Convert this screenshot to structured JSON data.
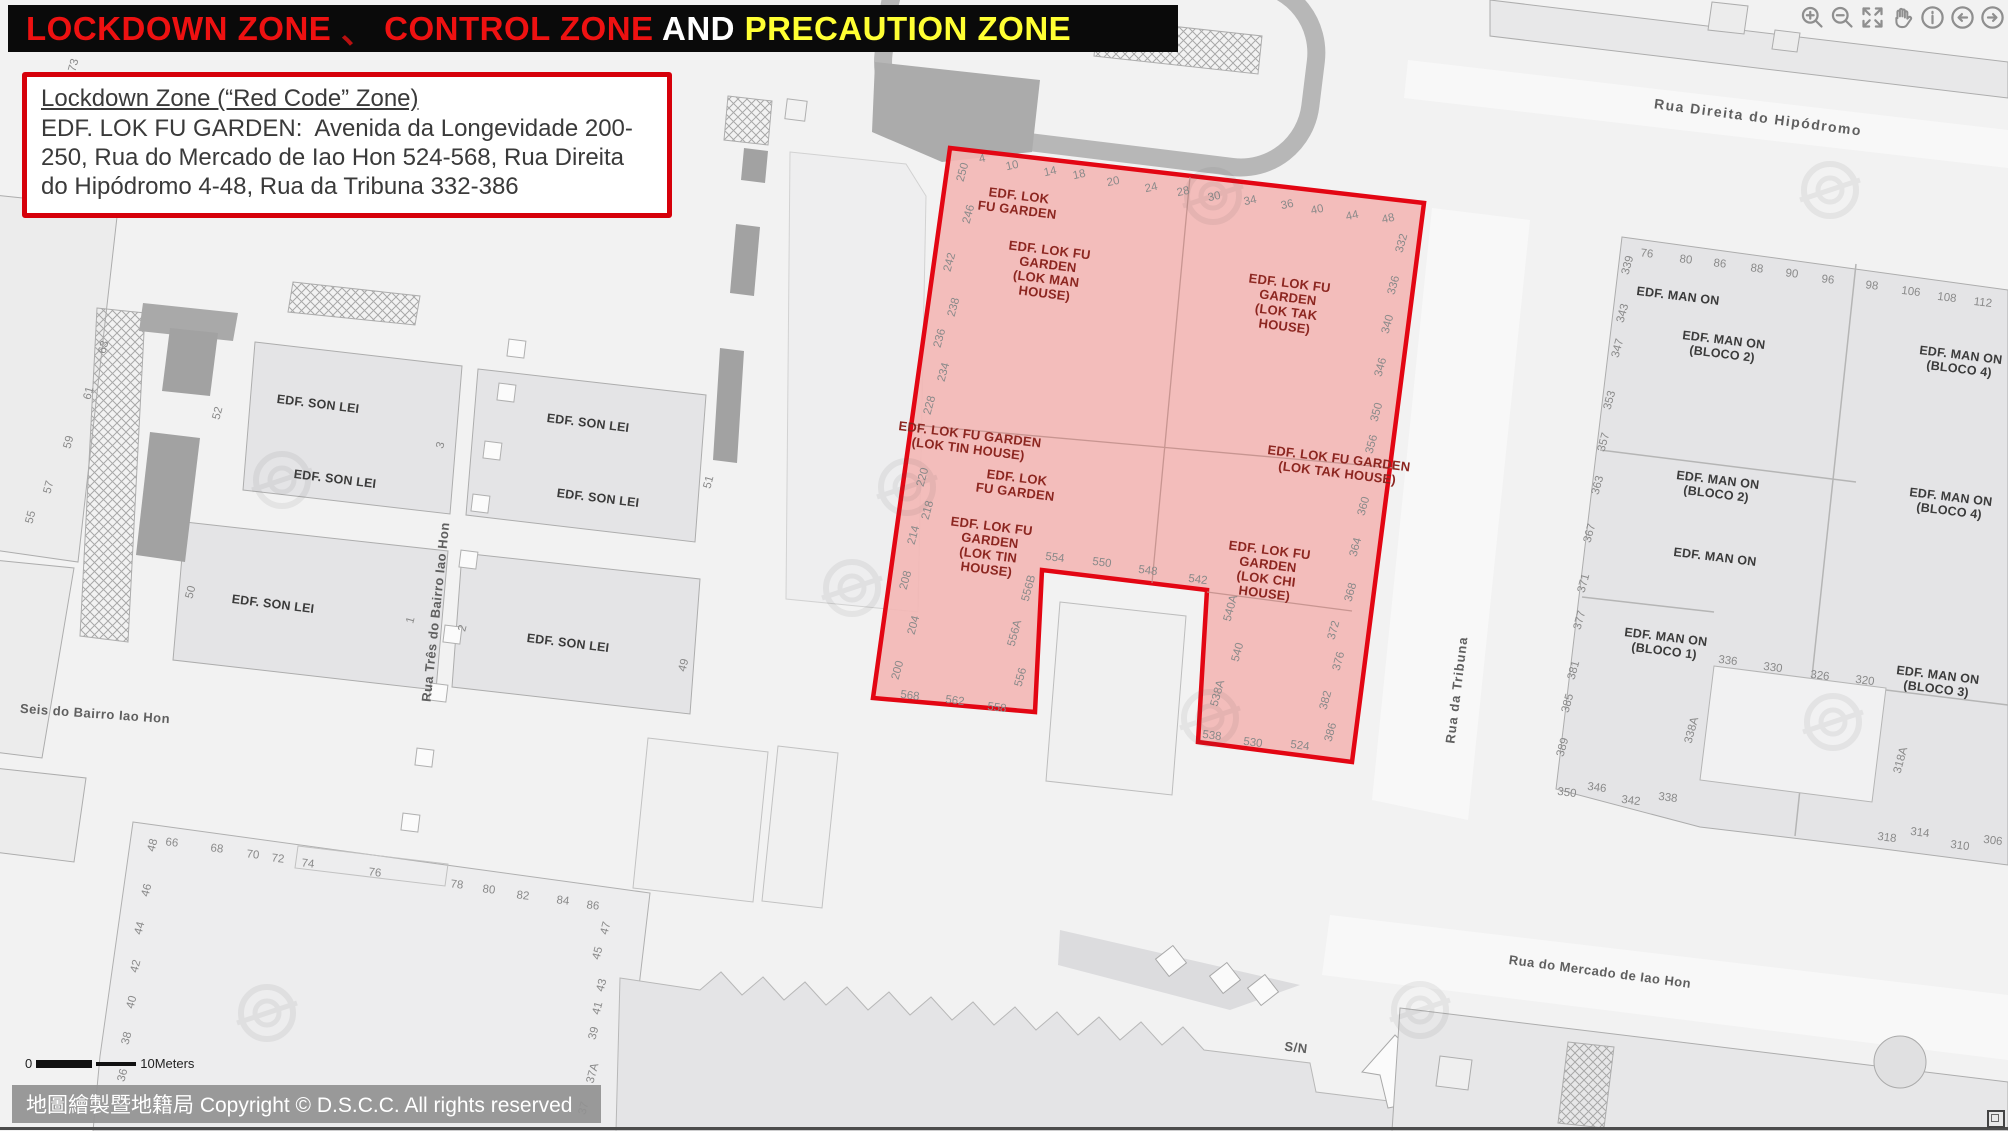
{
  "title": {
    "segments": [
      {
        "text": "LOCKDOWN ZONE",
        "color": "#ee1111"
      },
      {
        "text": " 、 ",
        "color": "#b81010"
      },
      {
        "text": "CONTROL ZONE",
        "color": "#ee1111"
      },
      {
        "text": " AND ",
        "color": "#ffffff"
      },
      {
        "text": "PRECAUTION ZONE",
        "color": "#ffff33"
      }
    ]
  },
  "info_box": {
    "heading": "Lockdown Zone (“Red Code” Zone)",
    "body": "EDF. LOK FU GARDEN:  Avenida da Longevidade 200-250, Rua do Mercado de Iao Hon 524-568, Rua Direita do Hipódromo 4-48, Rua da Tribuna 332-386"
  },
  "toolbar": {
    "icons": [
      {
        "name": "zoom-in"
      },
      {
        "name": "zoom-out"
      },
      {
        "name": "full-extent"
      },
      {
        "name": "pan"
      },
      {
        "name": "info"
      },
      {
        "name": "back"
      },
      {
        "name": "forward"
      }
    ]
  },
  "map": {
    "zone_fill": "#f3b7b5",
    "zone_border": "#e30613",
    "zone_label_color": "#8c2620",
    "building_label_color": "#3b3b3b",
    "number_color": "#8a8a8a",
    "street_color": "#5f5f5f",
    "streets": [
      {
        "t": "Rua Direita do Hipódromo",
        "x": 1758,
        "y": 118,
        "r": 7.5,
        "s": 14,
        "ls": 1.5
      },
      {
        "t": "Rua da Tribuna",
        "x": 1457,
        "y": 690,
        "r": -83,
        "s": 13,
        "ls": 1
      },
      {
        "t": "Rua Três do Bairro Iao Hon",
        "x": 436,
        "y": 612,
        "r": -84,
        "s": 13,
        "ls": 0.5
      },
      {
        "t": "Rua do Mercado de Iao Hon",
        "x": 1600,
        "y": 972,
        "r": 7.5,
        "s": 13,
        "ls": 0.5
      },
      {
        "t": "Seis do Bairro Iao Hon",
        "x": 95,
        "y": 714,
        "r": 4,
        "s": 13,
        "ls": 0.5
      },
      {
        "t": "Rua",
        "x": 489,
        "y": 180,
        "r": -84,
        "s": 12,
        "ls": 0
      },
      {
        "t": "S/N",
        "x": 1296,
        "y": 1048,
        "r": 7,
        "s": 13,
        "ls": 0.5
      }
    ],
    "zone_labels": [
      {
        "lines": [
          "EDF. LOK",
          "FU GARDEN"
        ],
        "x": 1018,
        "y": 203
      },
      {
        "lines": [
          "EDF. LOK FU",
          "GARDEN",
          "(LOK MAN",
          "HOUSE)"
        ],
        "x": 1047,
        "y": 272
      },
      {
        "lines": [
          "EDF. LOK FU",
          "GARDEN",
          "(LOK TAK",
          "HOUSE)"
        ],
        "x": 1287,
        "y": 305
      },
      {
        "lines": [
          "EDF. LOK FU GARDEN",
          "(LOK TIN HOUSE)"
        ],
        "x": 969,
        "y": 442
      },
      {
        "lines": [
          "EDF. LOK",
          "FU GARDEN"
        ],
        "x": 1016,
        "y": 485
      },
      {
        "lines": [
          "EDF. LOK FU",
          "GARDEN",
          "(LOK TIN",
          "HOUSE)"
        ],
        "x": 989,
        "y": 548
      },
      {
        "lines": [
          "EDF. LOK FU GARDEN",
          "(LOK TAK HOUSE)"
        ],
        "x": 1338,
        "y": 466
      },
      {
        "lines": [
          "EDF. LOK FU",
          "GARDEN",
          "(LOK CHI",
          "HOUSE)"
        ],
        "x": 1267,
        "y": 572
      }
    ],
    "building_labels": [
      {
        "lines": [
          "EDF. SON LEI"
        ],
        "x": 318,
        "y": 404
      },
      {
        "lines": [
          "EDF. SON LEI"
        ],
        "x": 335,
        "y": 479
      },
      {
        "lines": [
          "EDF. SON LEI"
        ],
        "x": 588,
        "y": 423
      },
      {
        "lines": [
          "EDF. SON LEI"
        ],
        "x": 598,
        "y": 498
      },
      {
        "lines": [
          "EDF. SON LEI"
        ],
        "x": 273,
        "y": 604
      },
      {
        "lines": [
          "EDF. SON LEI"
        ],
        "x": 568,
        "y": 643
      },
      {
        "lines": [
          "EDF. MAN ON"
        ],
        "x": 1678,
        "y": 296
      },
      {
        "lines": [
          "EDF. MAN ON",
          "(BLOCO 2)"
        ],
        "x": 1723,
        "y": 347
      },
      {
        "lines": [
          "EDF. MAN ON",
          "(BLOCO 4)"
        ],
        "x": 1960,
        "y": 362
      },
      {
        "lines": [
          "EDF. MAN ON",
          "(BLOCO 2)"
        ],
        "x": 1717,
        "y": 487
      },
      {
        "lines": [
          "EDF. MAN ON",
          "(BLOCO 4)"
        ],
        "x": 1950,
        "y": 504
      },
      {
        "lines": [
          "EDF. MAN ON"
        ],
        "x": 1715,
        "y": 557
      },
      {
        "lines": [
          "EDF. MAN ON",
          "(BLOCO 1)"
        ],
        "x": 1665,
        "y": 644
      },
      {
        "lines": [
          "EDF. MAN ON",
          "(BLOCO 3)"
        ],
        "x": 1937,
        "y": 682
      }
    ],
    "house_numbers": [
      [
        "4",
        982,
        158,
        -12
      ],
      [
        "10",
        1012,
        165,
        -12
      ],
      [
        "14",
        1050,
        171,
        -12
      ],
      [
        "18",
        1079,
        174,
        -12
      ],
      [
        "20",
        1113,
        181,
        -12
      ],
      [
        "24",
        1151,
        187,
        -12
      ],
      [
        "28",
        1183,
        191,
        -12
      ],
      [
        "30",
        1214,
        196,
        -12
      ],
      [
        "34",
        1250,
        200,
        -12
      ],
      [
        "36",
        1287,
        204,
        -12
      ],
      [
        "40",
        1317,
        209,
        -12
      ],
      [
        "44",
        1352,
        215,
        -12
      ],
      [
        "48",
        1388,
        218,
        -12
      ],
      [
        "250",
        962,
        172,
        -75
      ],
      [
        "246",
        968,
        214,
        -75
      ],
      [
        "242",
        949,
        262,
        -75
      ],
      [
        "238",
        953,
        307,
        -75
      ],
      [
        "236",
        939,
        338,
        -75
      ],
      [
        "234",
        943,
        372,
        -75
      ],
      [
        "228",
        929,
        405,
        -75
      ],
      [
        "220",
        922,
        477,
        -75
      ],
      [
        "218",
        927,
        510,
        -75
      ],
      [
        "214",
        913,
        535,
        -75
      ],
      [
        "208",
        905,
        580,
        -75
      ],
      [
        "204",
        913,
        625,
        -75
      ],
      [
        "200",
        897,
        670,
        -75
      ],
      [
        "332",
        1401,
        243,
        -75
      ],
      [
        "336",
        1393,
        285,
        -75
      ],
      [
        "340",
        1387,
        324,
        -75
      ],
      [
        "346",
        1380,
        367,
        -75
      ],
      [
        "350",
        1376,
        412,
        -75
      ],
      [
        "356",
        1371,
        444,
        -75
      ],
      [
        "360",
        1363,
        506,
        -75
      ],
      [
        "364",
        1355,
        547,
        -75
      ],
      [
        "368",
        1350,
        592,
        -75
      ],
      [
        "372",
        1333,
        630,
        -75
      ],
      [
        "376",
        1338,
        661,
        -75
      ],
      [
        "382",
        1325,
        700,
        -75
      ],
      [
        "386",
        1330,
        732,
        -75
      ],
      [
        "568",
        910,
        695,
        7
      ],
      [
        "562",
        955,
        700,
        7
      ],
      [
        "558",
        997,
        707,
        7
      ],
      [
        "556",
        1020,
        677,
        -75
      ],
      [
        "556A",
        1014,
        633,
        -75
      ],
      [
        "556B",
        1028,
        588,
        -75
      ],
      [
        "554",
        1055,
        557,
        7
      ],
      [
        "550",
        1102,
        562,
        7
      ],
      [
        "548",
        1148,
        570,
        7
      ],
      [
        "542",
        1198,
        579,
        7
      ],
      [
        "540A",
        1230,
        608,
        -75
      ],
      [
        "540",
        1237,
        652,
        -75
      ],
      [
        "538A",
        1217,
        693,
        -75
      ],
      [
        "538",
        1212,
        735,
        7
      ],
      [
        "530",
        1253,
        742,
        7
      ],
      [
        "524",
        1300,
        745,
        7
      ],
      [
        "73",
        73,
        65,
        -75
      ],
      [
        "63",
        103,
        347,
        -75
      ],
      [
        "61",
        88,
        393,
        -75
      ],
      [
        "59",
        68,
        442,
        -75
      ],
      [
        "57",
        48,
        487,
        -75
      ],
      [
        "55",
        30,
        517,
        -75
      ],
      [
        "52",
        217,
        413,
        -75
      ],
      [
        "3",
        440,
        445,
        -75
      ],
      [
        "51",
        708,
        482,
        -75
      ],
      [
        "50",
        190,
        592,
        -75
      ],
      [
        "1",
        410,
        620,
        -75
      ],
      [
        "2",
        462,
        628,
        -75
      ],
      [
        "49",
        683,
        665,
        -75
      ],
      [
        "48",
        152,
        845,
        -75
      ],
      [
        "66",
        172,
        842,
        7
      ],
      [
        "68",
        217,
        848,
        7
      ],
      [
        "70",
        253,
        854,
        7
      ],
      [
        "72",
        278,
        858,
        7
      ],
      [
        "74",
        308,
        863,
        7
      ],
      [
        "76",
        375,
        872,
        7
      ],
      [
        "78",
        457,
        884,
        7
      ],
      [
        "80",
        489,
        889,
        7
      ],
      [
        "82",
        523,
        895,
        7
      ],
      [
        "84",
        563,
        900,
        7
      ],
      [
        "86",
        593,
        905,
        7
      ],
      [
        "46",
        146,
        890,
        -75
      ],
      [
        "44",
        139,
        928,
        -75
      ],
      [
        "42",
        135,
        966,
        -75
      ],
      [
        "40",
        131,
        1002,
        -75
      ],
      [
        "38",
        126,
        1038,
        -75
      ],
      [
        "36",
        122,
        1075,
        -75
      ],
      [
        "47",
        605,
        928,
        -75
      ],
      [
        "45",
        597,
        953,
        -75
      ],
      [
        "43",
        601,
        985,
        -75
      ],
      [
        "41",
        597,
        1008,
        -75
      ],
      [
        "39",
        593,
        1033,
        -75
      ],
      [
        "37A",
        592,
        1073,
        -75
      ],
      [
        "37",
        583,
        1108,
        -75
      ],
      [
        "76",
        1647,
        253,
        7
      ],
      [
        "80",
        1686,
        259,
        7
      ],
      [
        "86",
        1720,
        263,
        7
      ],
      [
        "88",
        1757,
        268,
        7
      ],
      [
        "90",
        1792,
        273,
        7
      ],
      [
        "96",
        1828,
        279,
        7
      ],
      [
        "98",
        1872,
        285,
        7
      ],
      [
        "106",
        1911,
        291,
        7
      ],
      [
        "108",
        1947,
        297,
        7
      ],
      [
        "112",
        1983,
        302,
        7
      ],
      [
        "339",
        1627,
        265,
        -75
      ],
      [
        "343",
        1622,
        313,
        -75
      ],
      [
        "347",
        1617,
        348,
        -75
      ],
      [
        "353",
        1609,
        400,
        -75
      ],
      [
        "357",
        1603,
        442,
        -75
      ],
      [
        "363",
        1597,
        485,
        -75
      ],
      [
        "367",
        1589,
        533,
        -75
      ],
      [
        "371",
        1583,
        583,
        -75
      ],
      [
        "377",
        1579,
        620,
        -75
      ],
      [
        "381",
        1573,
        670,
        -75
      ],
      [
        "385",
        1567,
        703,
        -75
      ],
      [
        "389",
        1562,
        747,
        -75
      ],
      [
        "350",
        1567,
        792,
        7
      ],
      [
        "346",
        1597,
        787,
        7
      ],
      [
        "342",
        1631,
        800,
        7
      ],
      [
        "338",
        1668,
        797,
        7
      ],
      [
        "338A",
        1691,
        730,
        -75
      ],
      [
        "336",
        1728,
        660,
        7
      ],
      [
        "330",
        1773,
        667,
        7
      ],
      [
        "326",
        1820,
        675,
        7
      ],
      [
        "320",
        1865,
        680,
        7
      ],
      [
        "318A",
        1900,
        760,
        -75
      ],
      [
        "318",
        1887,
        837,
        7
      ],
      [
        "314",
        1920,
        832,
        7
      ],
      [
        "310",
        1960,
        845,
        7
      ],
      [
        "306",
        1993,
        840,
        7
      ]
    ],
    "scale_bar": {
      "zero": "0",
      "label": "10Meters"
    },
    "copyright": "地圖繪製暨地籍局 Copyright © D.S.C.C. All rights reserved"
  }
}
